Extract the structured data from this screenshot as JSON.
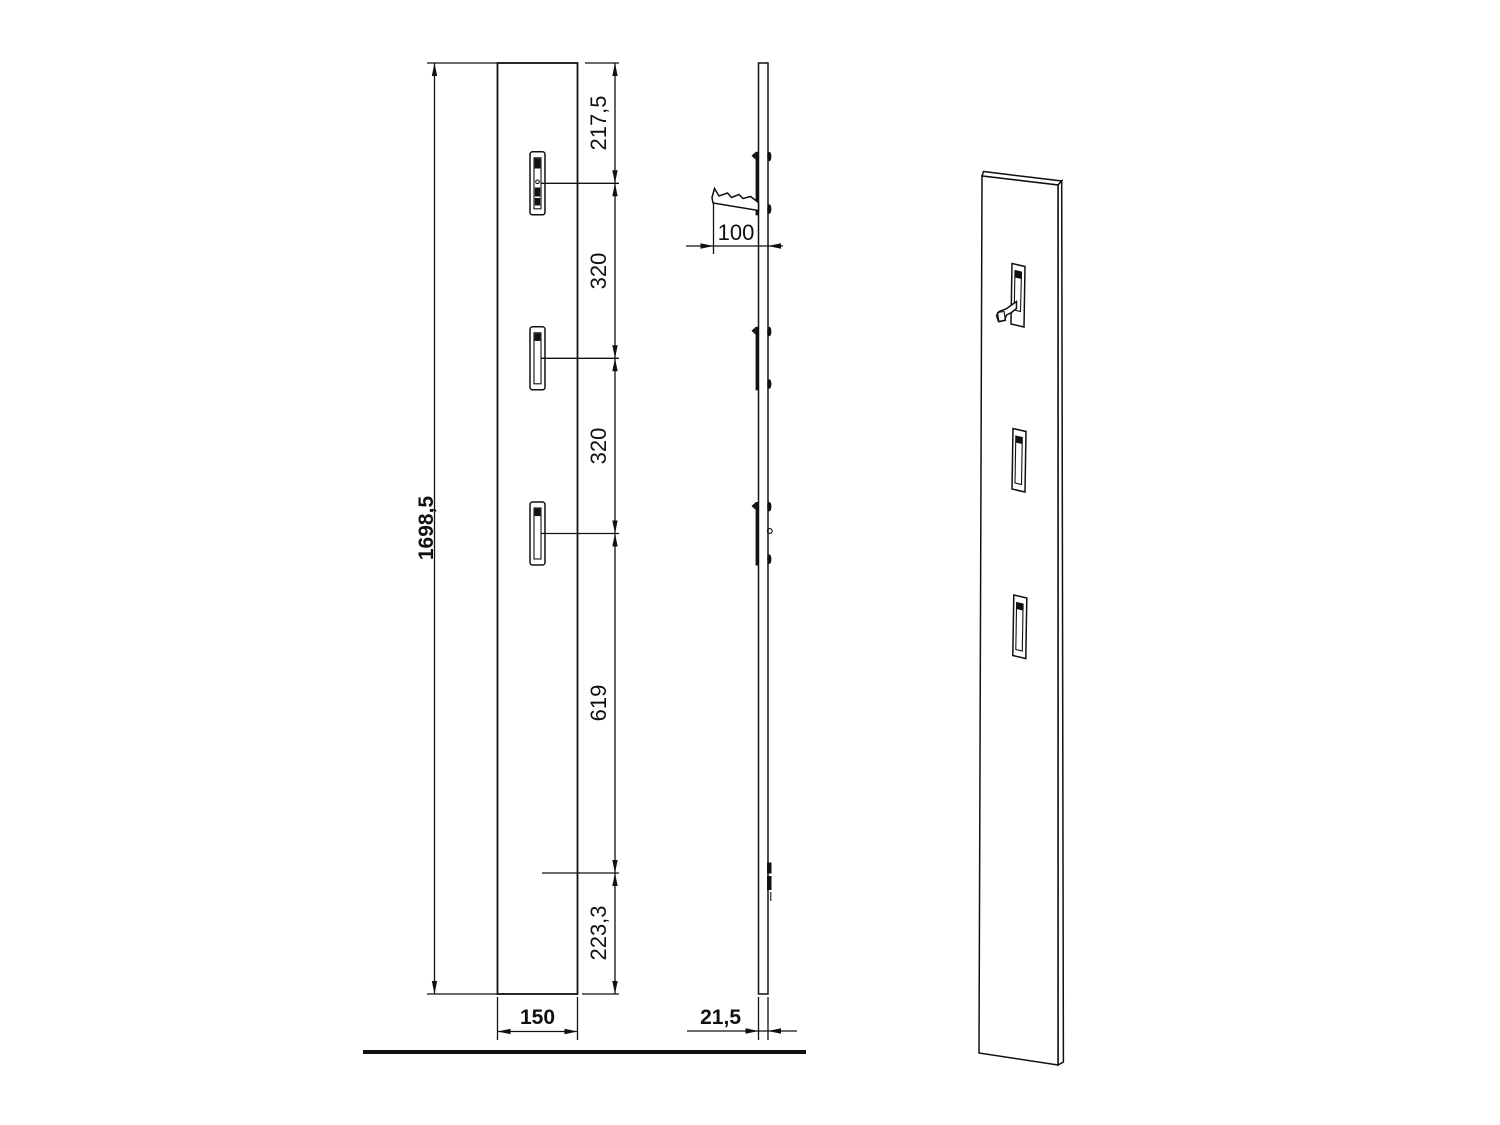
{
  "dimensions": {
    "overall_height": "1698,5",
    "panel_width": "150",
    "panel_thickness": "21,5",
    "hook_projection": "100",
    "spacings": [
      "217,5",
      "320",
      "320",
      "619",
      "223,3"
    ]
  },
  "colors": {
    "line": "#111111",
    "background": "#ffffff"
  }
}
